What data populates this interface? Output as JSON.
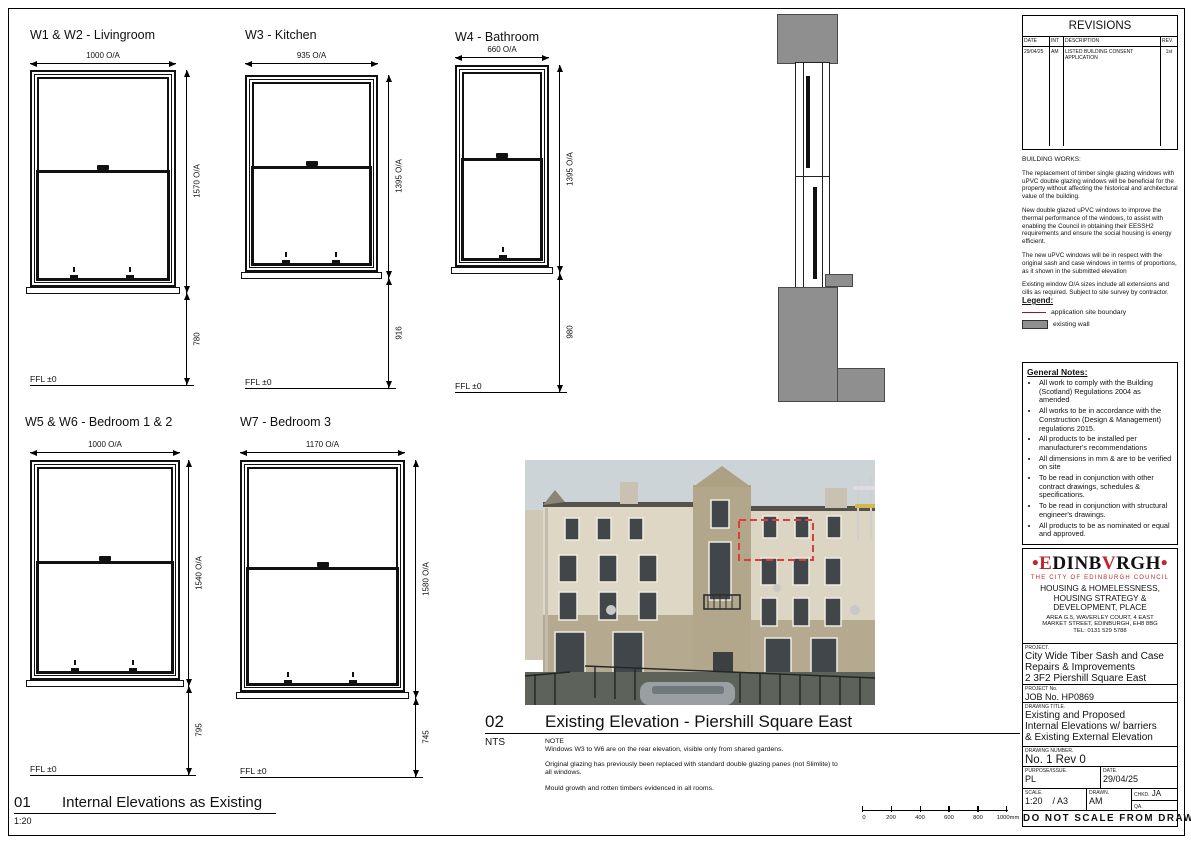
{
  "colors": {
    "boundary_red": "#8c1a2b",
    "wall_gray": "#8f8f8f",
    "logo_red": "#c1272d",
    "photo_dash_red": "#e03b3b"
  },
  "sheet": {
    "windows": [
      {
        "title": "W1 & W2 - Livingroom",
        "width": "1000 O/A",
        "height": "1570 O/A",
        "sill": "780",
        "ffl": "FFL ±0"
      },
      {
        "title": "W3 - Kitchen",
        "width": "935 O/A",
        "height": "1395 O/A",
        "sill": "916",
        "ffl": "FFL ±0"
      },
      {
        "title": "W4 - Bathroom",
        "width": "660 O/A",
        "height": "1395 O/A",
        "sill": "980",
        "ffl": "FFL ±0"
      },
      {
        "title": "W5 & W6 - Bedroom 1 & 2",
        "width": "1000 O/A",
        "height": "1540 O/A",
        "sill": "795",
        "ffl": "FFL ±0"
      },
      {
        "title": "W7 - Bedroom 3",
        "width": "1170 O/A",
        "height": "1580 O/A",
        "sill": "745",
        "ffl": "FFL ±0"
      }
    ],
    "captions": {
      "c01": {
        "number": "01",
        "title": "Internal Elevations as Existing",
        "scale": "1:20"
      },
      "c02": {
        "number": "02",
        "title": "Existing Elevation - Piershill Square East",
        "scale": "NTS",
        "note_label": "NOTE",
        "notes": [
          "Windows W3 to W6 are on the rear elevation, visible only from shared gardens.",
          "Original glazing has previously been replaced with standard double glazing panes (not Slimlite) to all windows.",
          "Mould growth and rotten timbers evidenced in all rooms."
        ]
      }
    },
    "scalebar": {
      "ticks": [
        "0",
        "200",
        "400",
        "600",
        "800",
        "1000mm"
      ]
    },
    "revisions": {
      "title": "REVISIONS",
      "headers": [
        "DATE",
        "INT",
        "DESCRIPTION",
        "REV."
      ],
      "rows": [
        {
          "date": "29/04/25",
          "int": "AM",
          "description": "LISTED BUILDING CONSENT APPLICATION",
          "rev": "1st"
        }
      ]
    },
    "building_works": {
      "heading": "BUILDING WORKS:",
      "paragraphs": [
        "The replacement of timber single glazing windows with uPVC double glazing windows will be beneficial for the property without affecting the historical and architectural value of the building.",
        "New double glazed uPVC windows to improve the thermal performance of the windows, to assist with enabling the Council in obtaining their EESSH2 requirements and ensure the social housing is energy efficient.",
        "The new uPVC windows will be in respect with the original sash and case windows in terms of proportions, as it shown in the submitted elevation",
        "Existing window O/A sizes include all extensions and cills as required. Subject to site survey by contractor."
      ]
    },
    "legend": {
      "heading": "Legend:",
      "items": [
        {
          "label": "application site boundary"
        },
        {
          "label": "existing wall"
        }
      ]
    },
    "general_notes": {
      "heading": "General Notes:",
      "items": [
        "All work to comply with the Building (Scotland) Regulations 2004 as amended",
        "All works to be in accordance with the Construction (Design & Management) regulations 2015.",
        "All products to be installed per manufacturer's recommendations",
        "All dimensions in mm & are to be verified on site",
        "To be read in conjunction with other contract drawings, schedules & specifications.",
        "To be read in conjunction with structural engineer's drawings.",
        "All products to be as nominated or equal and approved."
      ]
    },
    "office": {
      "logo": {
        "d1": "•",
        "p1": "E",
        "p2": "DINB",
        "p3": "V",
        "p4": "RGH",
        "d2": "•"
      },
      "tagline": "THE CITY OF EDINBURGH COUNCIL",
      "dept": [
        "HOUSING & HOMELESSNESS,",
        "HOUSING STRATEGY &",
        "DEVELOPMENT, PLACE"
      ],
      "address": [
        "AREA G.5, WAVERLEY COURT, 4 EAST",
        "MARKET STREET, EDINBURGH, EH8 8BG",
        "TEL: 0131 529 5788"
      ]
    },
    "tb": {
      "project_label": "PROJECT.",
      "project": [
        "City Wide Tiber Sash and Case",
        "Repairs & Improvements",
        "2 3F2 Piershill Square East"
      ],
      "jobno_label": "PROJECT No.",
      "jobno": "JOB No. HP0869",
      "title_label": "DRAWING TITLE.",
      "title": [
        "Existing and Proposed",
        "Internal Elevations w/ barriers",
        "& Existing External Elevation"
      ],
      "number_label": "DRAWING NUMBER.",
      "number": "No. 1 Rev 0",
      "purpose_label": "PURPOSE/ISSUE.",
      "purpose": "PL",
      "date_label": "DATE.",
      "date": "29/04/25",
      "scale_label": "SCALE.",
      "scale": "1:20    / A3",
      "drawn_label": "DRAWN.",
      "drawn": "AM",
      "chkd_label": "CHKD.",
      "chkd": "JA",
      "qa_label": "QA.",
      "qa": "",
      "footer": "DO NOT SCALE FROM DRAWING"
    }
  }
}
